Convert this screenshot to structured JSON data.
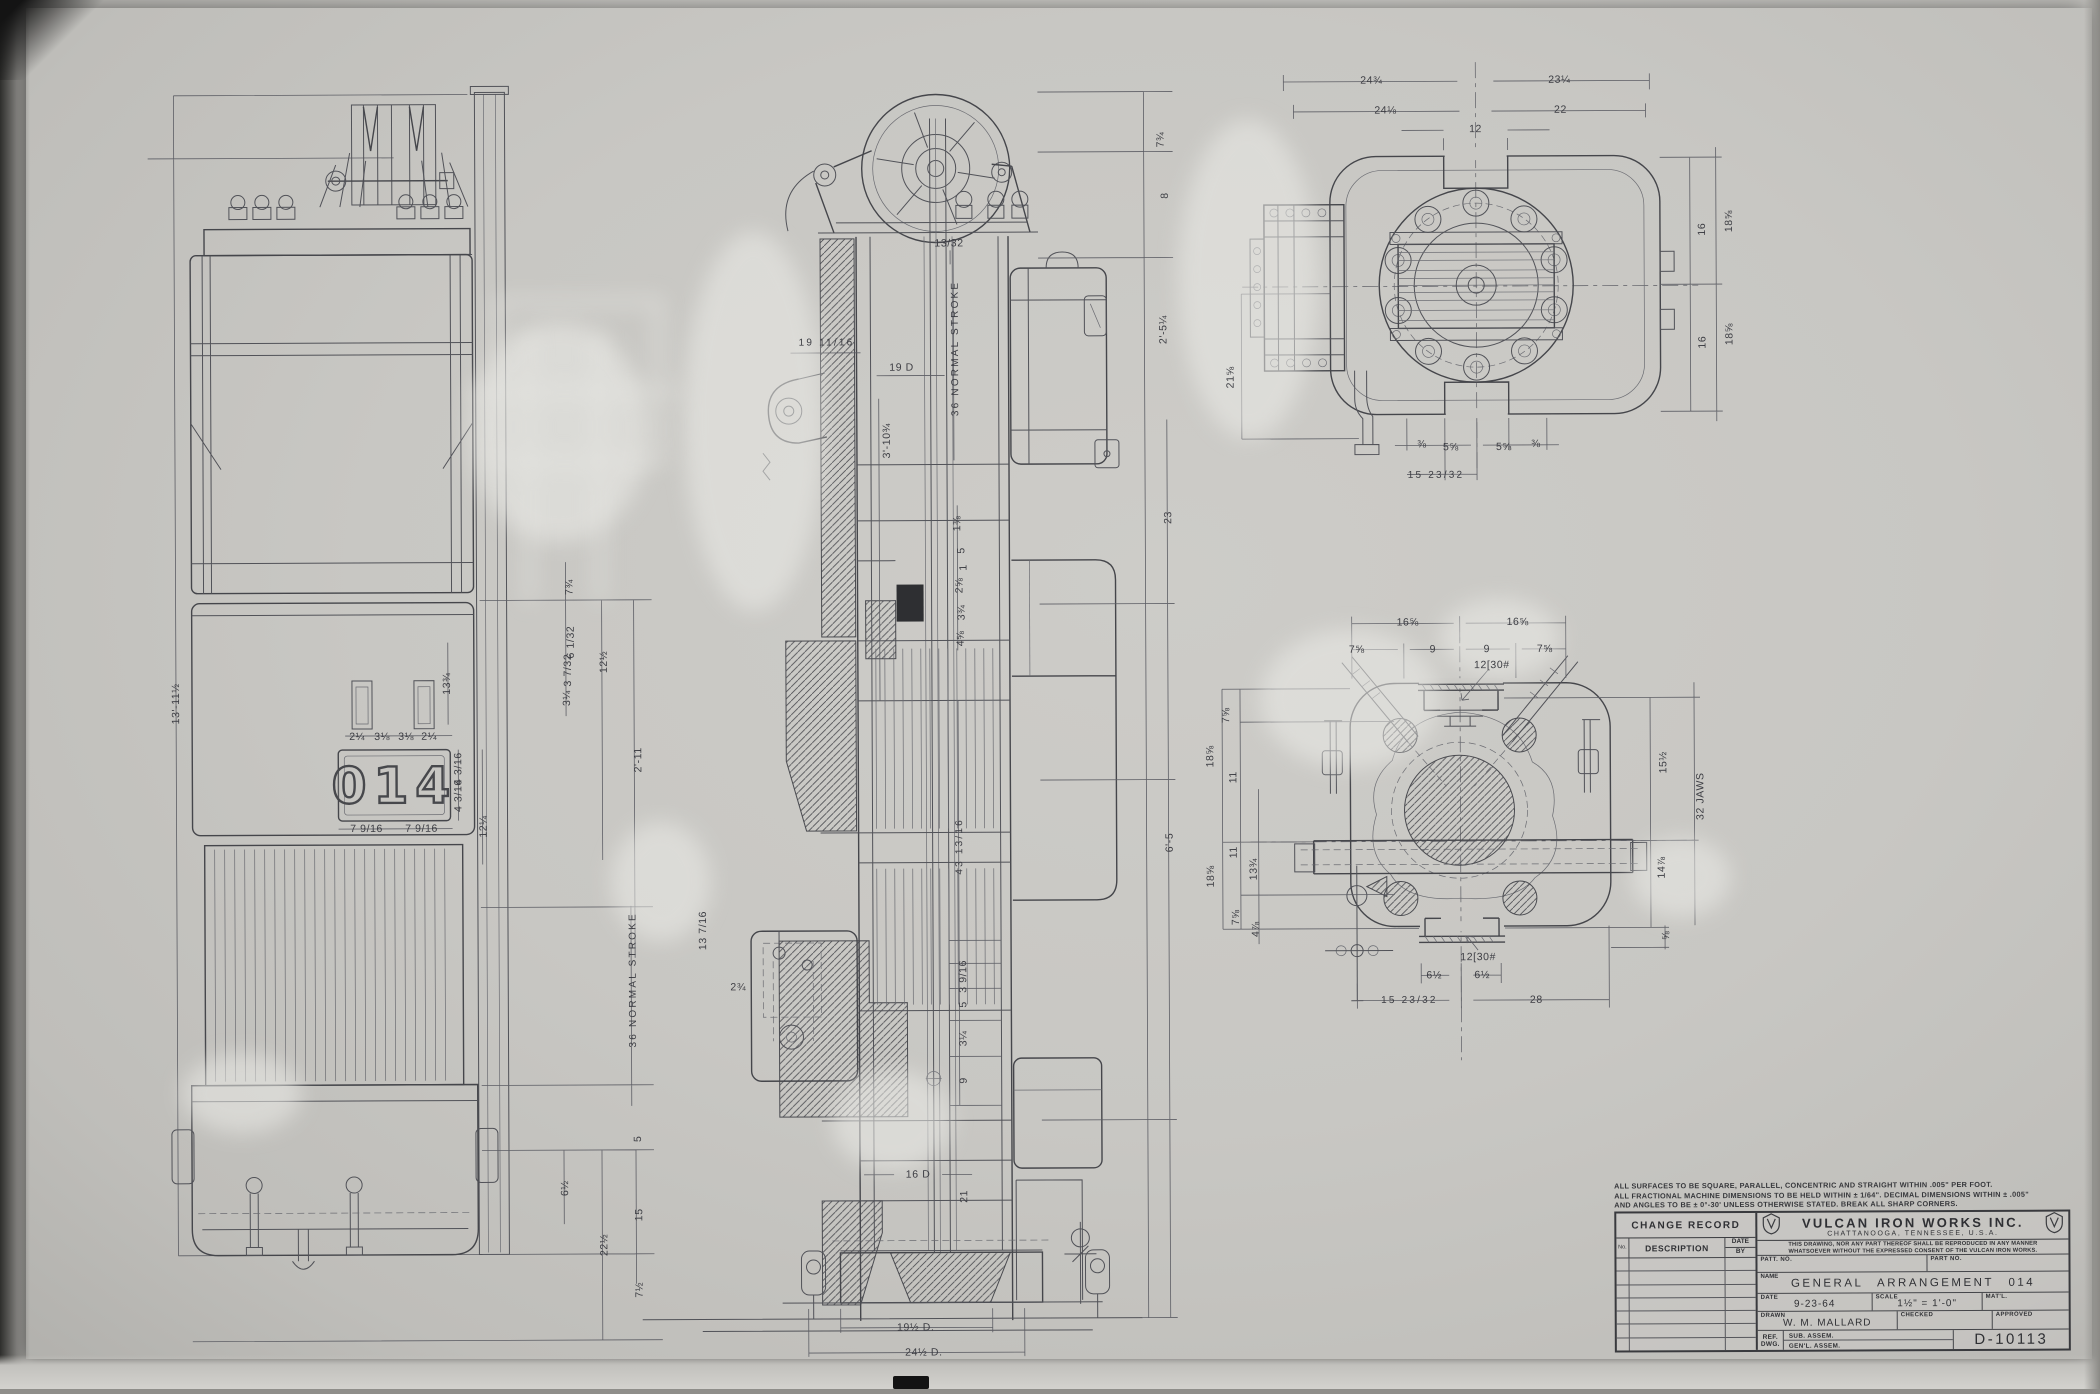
{
  "nameplate": {
    "value": "014"
  },
  "notes": [
    "ALL SURFACES TO BE SQUARE, PARALLEL, CONCENTRIC AND STRAIGHT WITHIN .005\" PER FOOT.",
    "ALL FRACTIONAL MACHINE DIMENSIONS TO BE HELD WITHIN ± 1/64\". DECIMAL DIMENSIONS WITHIN ± .005\"",
    "AND ANGLES TO BE ± 0°-30' UNLESS OTHERWISE STATED. BREAK ALL SHARP CORNERS."
  ],
  "title_block": {
    "change_record": {
      "title": "CHANGE RECORD",
      "col_no": "No.",
      "col_description": "DESCRIPTION",
      "col_date": "DATE",
      "col_by": "BY"
    },
    "company": "VULCAN IRON WORKS INC.",
    "location": "CHATTANOOGA, TENNESSEE, U.S.A.",
    "disclaimer_1": "THIS DRAWING, NOR ANY PART THEREOF SHALL BE REPRODUCED IN ANY MANNER",
    "disclaimer_2": "WHATSOEVER WITHOUT THE EXPRESSED CONSENT OF THE VULCAN IRON WORKS.",
    "patt_no_label": "PATT. NO.",
    "part_no_label": "PART NO.",
    "name_label": "NAME",
    "name_value": "GENERAL ARRANGEMENT 014",
    "date_label": "DATE",
    "date_value": "9-23-64",
    "scale_label": "SCALE",
    "scale_value": "1½\" = 1'-0\"",
    "matl_label": "MAT'L.",
    "drawn_label": "DRAWN",
    "drawn_value": "W. M. MALLARD",
    "checked_label": "CHECKED",
    "approved_label": "APPROVED",
    "ref_label_1": "REF.",
    "ref_label_2": "DWG.",
    "ref_row_1": "SUB. ASSEM.",
    "ref_row_2": "GEN'L. ASSEM.",
    "drawing_number": "D-10113"
  },
  "dimensions": [
    {
      "t": "13'-11½",
      "x": 176,
      "y": 700,
      "r": -90
    },
    {
      "t": "7¾",
      "x": 570,
      "y": 585,
      "r": -90
    },
    {
      "t": "6 1/32",
      "x": 571,
      "y": 640,
      "r": -90
    },
    {
      "t": "3 7/32",
      "x": 568,
      "y": 668,
      "r": -90
    },
    {
      "t": "3¼",
      "x": 567,
      "y": 696,
      "r": -90
    },
    {
      "t": "12½",
      "x": 604,
      "y": 660,
      "r": -90
    },
    {
      "t": "2'-11",
      "x": 638,
      "y": 758,
      "r": -90
    },
    {
      "t": "13¾",
      "x": 447,
      "y": 681,
      "r": -90
    },
    {
      "t": "2¼",
      "x": 357,
      "y": 734
    },
    {
      "t": "3⅛",
      "x": 382,
      "y": 734
    },
    {
      "t": "3⅛",
      "x": 406,
      "y": 734
    },
    {
      "t": "2¼",
      "x": 429,
      "y": 734
    },
    {
      "t": "7 9/16",
      "x": 366,
      "y": 826
    },
    {
      "t": "7 9/16",
      "x": 421,
      "y": 826
    },
    {
      "t": "4 3/16",
      "x": 458,
      "y": 766,
      "r": -90
    },
    {
      "t": "4 3/16",
      "x": 458,
      "y": 793,
      "r": -90
    },
    {
      "t": "12¼",
      "x": 483,
      "y": 824,
      "r": -90
    },
    {
      "t": "36 NORMAL STROKE",
      "x": 632,
      "y": 978,
      "r": -90
    },
    {
      "t": "5",
      "x": 636,
      "y": 1137,
      "r": -90
    },
    {
      "t": "6½",
      "x": 563,
      "y": 1186,
      "r": -90
    },
    {
      "t": "15",
      "x": 637,
      "y": 1213,
      "r": -90
    },
    {
      "t": "22½",
      "x": 602,
      "y": 1243,
      "r": -90
    },
    {
      "t": "7½",
      "x": 637,
      "y": 1288,
      "r": -90
    },
    {
      "t": "7¾",
      "x": 1163,
      "y": 140,
      "r": -90
    },
    {
      "t": "8",
      "x": 1167,
      "y": 196,
      "r": -90
    },
    {
      "t": "2'-5¼",
      "x": 1165,
      "y": 330,
      "r": -90
    },
    {
      "t": "23",
      "x": 1169,
      "y": 518,
      "r": -90
    },
    {
      "t": "6'-5",
      "x": 1169,
      "y": 843,
      "r": -90
    },
    {
      "t": "13/32",
      "x": 951,
      "y": 243
    },
    {
      "t": "19 11/16",
      "x": 828,
      "y": 342
    },
    {
      "t": "19 D",
      "x": 903,
      "y": 367
    },
    {
      "t": "3'-10¾",
      "x": 888,
      "y": 440,
      "r": -90
    },
    {
      "t": "36 NORMAL STROKE",
      "x": 957,
      "y": 348,
      "r": -90
    },
    {
      "t": "1⅜",
      "x": 958,
      "y": 523,
      "r": -90
    },
    {
      "t": "5",
      "x": 962,
      "y": 550,
      "r": -90
    },
    {
      "t": "1",
      "x": 964,
      "y": 567,
      "r": -90
    },
    {
      "t": "2⅝",
      "x": 960,
      "y": 585,
      "r": -90
    },
    {
      "t": "3¾",
      "x": 962,
      "y": 612,
      "r": -90
    },
    {
      "t": "4⅝",
      "x": 961,
      "y": 638,
      "r": -90
    },
    {
      "t": "13 7/16",
      "x": 702,
      "y": 929,
      "r": -90
    },
    {
      "t": "2¾",
      "x": 737,
      "y": 986
    },
    {
      "t": "43 13/16",
      "x": 959,
      "y": 846,
      "r": -90
    },
    {
      "t": "3 9/16",
      "x": 962,
      "y": 976,
      "r": -90
    },
    {
      "t": "5",
      "x": 962,
      "y": 1004,
      "r": -90
    },
    {
      "t": "3¼",
      "x": 962,
      "y": 1038,
      "r": -90
    },
    {
      "t": "9",
      "x": 962,
      "y": 1080,
      "r": -90
    },
    {
      "t": "16 D",
      "x": 916,
      "y": 1174
    },
    {
      "t": "21",
      "x": 962,
      "y": 1196,
      "r": -90
    },
    {
      "t": "19½ D.",
      "x": 913,
      "y": 1327
    },
    {
      "t": "24½ D.",
      "x": 921,
      "y": 1352
    },
    {
      "t": "24¾",
      "x": 1374,
      "y": 82
    },
    {
      "t": "23¼",
      "x": 1562,
      "y": 82
    },
    {
      "t": "24⅛",
      "x": 1388,
      "y": 112
    },
    {
      "t": "22",
      "x": 1563,
      "y": 112
    },
    {
      "t": "12",
      "x": 1478,
      "y": 131
    },
    {
      "t": "16",
      "x": 1704,
      "y": 232,
      "r": -90
    },
    {
      "t": "18⅝",
      "x": 1731,
      "y": 224,
      "r": -90
    },
    {
      "t": "16",
      "x": 1704,
      "y": 345,
      "r": -90
    },
    {
      "t": "18⅝",
      "x": 1731,
      "y": 337,
      "r": -90
    },
    {
      "t": "21⅝",
      "x": 1232,
      "y": 378,
      "r": -90
    },
    {
      "t": "⅜",
      "x": 1423,
      "y": 446
    },
    {
      "t": "5⅝",
      "x": 1452,
      "y": 449
    },
    {
      "t": "5⅝",
      "x": 1505,
      "y": 449
    },
    {
      "t": "⅜",
      "x": 1537,
      "y": 446
    },
    {
      "t": "15 23/32",
      "x": 1437,
      "y": 477
    },
    {
      "t": "16⅝",
      "x": 1408,
      "y": 624
    },
    {
      "t": "16⅝",
      "x": 1518,
      "y": 624
    },
    {
      "t": "7⅝",
      "x": 1357,
      "y": 651
    },
    {
      "t": "9",
      "x": 1433,
      "y": 651
    },
    {
      "t": "9",
      "x": 1487,
      "y": 651
    },
    {
      "t": "7⅝",
      "x": 1545,
      "y": 651
    },
    {
      "t": "12[30#",
      "x": 1492,
      "y": 667
    },
    {
      "t": "7⅝",
      "x": 1226,
      "y": 716,
      "r": -90
    },
    {
      "t": "18⅝",
      "x": 1210,
      "y": 757,
      "r": -90
    },
    {
      "t": "11",
      "x": 1233,
      "y": 778,
      "r": -90
    },
    {
      "t": "11",
      "x": 1233,
      "y": 853,
      "r": -90
    },
    {
      "t": "18⅝",
      "x": 1210,
      "y": 877,
      "r": -90
    },
    {
      "t": "13¾",
      "x": 1253,
      "y": 870,
      "r": -90
    },
    {
      "t": "7⅝",
      "x": 1235,
      "y": 918,
      "r": -90
    },
    {
      "t": "4⅞",
      "x": 1255,
      "y": 930,
      "r": -90
    },
    {
      "t": "15½",
      "x": 1663,
      "y": 765,
      "r": -90
    },
    {
      "t": "32 JAWS",
      "x": 1700,
      "y": 799,
      "r": -90
    },
    {
      "t": "14⅞",
      "x": 1661,
      "y": 870,
      "r": -90
    },
    {
      "t": "⅝",
      "x": 1665,
      "y": 938,
      "r": -90
    },
    {
      "t": "12[30#",
      "x": 1477,
      "y": 959
    },
    {
      "t": "6½",
      "x": 1433,
      "y": 977
    },
    {
      "t": "6½",
      "x": 1481,
      "y": 977
    },
    {
      "t": "15 23/32",
      "x": 1408,
      "y": 1002
    },
    {
      "t": "28",
      "x": 1535,
      "y": 1002
    }
  ]
}
